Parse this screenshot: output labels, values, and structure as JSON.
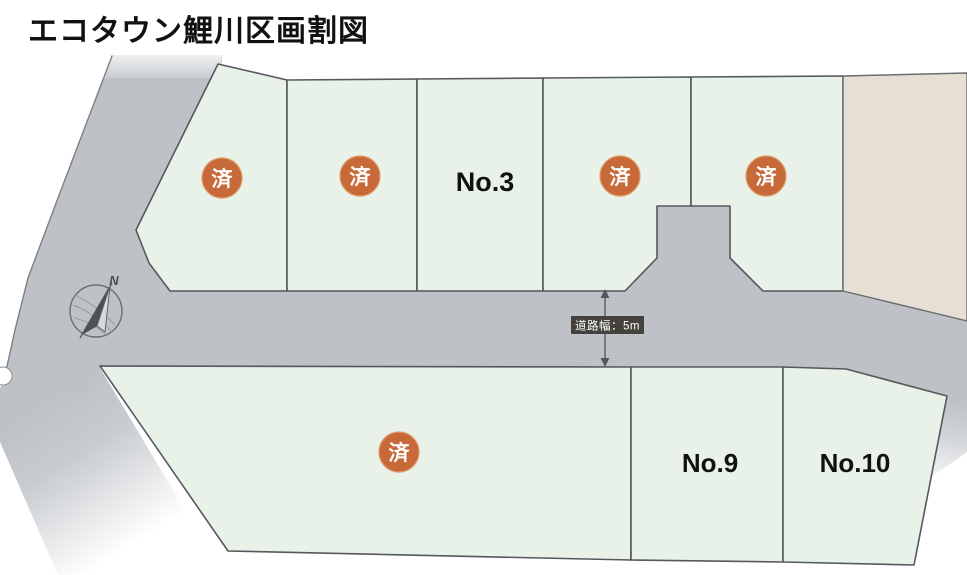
{
  "title": "エコタウン鯉川区画割図",
  "map": {
    "compass_label": "N",
    "road_width_label": "道路幅：5m",
    "lots_top_row": [
      {
        "label": "済",
        "type": "sold"
      },
      {
        "label": "済",
        "type": "sold"
      },
      {
        "label": "No.3",
        "type": "available"
      },
      {
        "label": "済",
        "type": "sold"
      },
      {
        "label": "済",
        "type": "sold"
      }
    ],
    "lots_bottom_row": [
      {
        "label": "済",
        "type": "sold"
      },
      {
        "label": "No.9",
        "type": "available"
      },
      {
        "label": "No.10",
        "type": "available"
      }
    ]
  },
  "colors": {
    "lot_fill": "#e9f2e9",
    "road_fill": "#bec2c7",
    "neighbor_fill": "#e6dfd4",
    "badge_fill": "#c8693a",
    "badge_text": "#ffffff",
    "label_box_fill": "#45423d",
    "label_box_text": "#ffffff"
  }
}
